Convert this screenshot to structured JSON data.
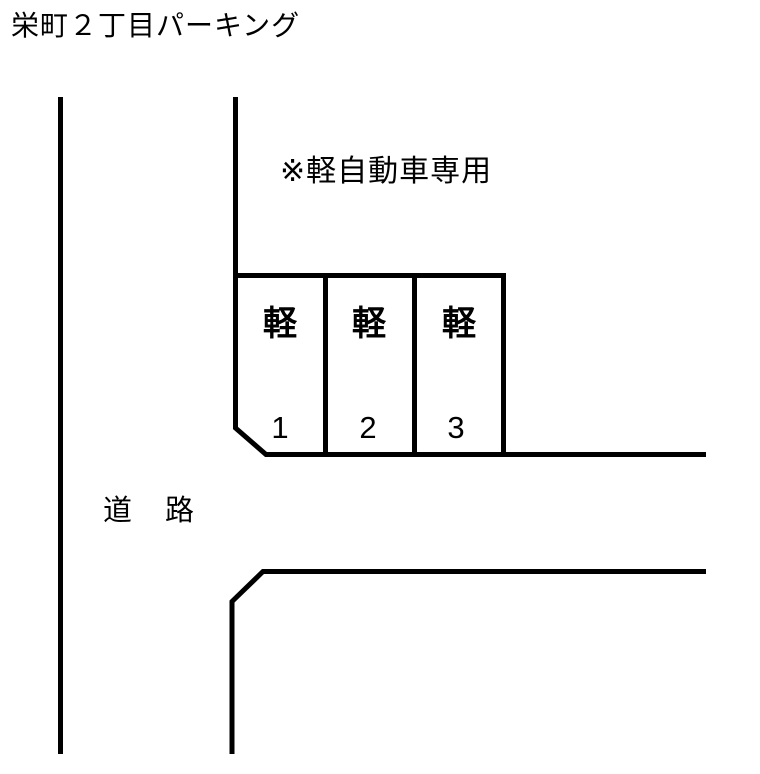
{
  "page_title": "栄町２丁目パーキング",
  "note": "※軽自動車専用",
  "road_label": "道　路",
  "stalls": [
    {
      "type_label": "軽",
      "number": "1"
    },
    {
      "type_label": "軽",
      "number": "2"
    },
    {
      "type_label": "軽",
      "number": "3"
    }
  ],
  "colors": {
    "background": "#ffffff",
    "line": "#000000",
    "text": "#000000"
  }
}
